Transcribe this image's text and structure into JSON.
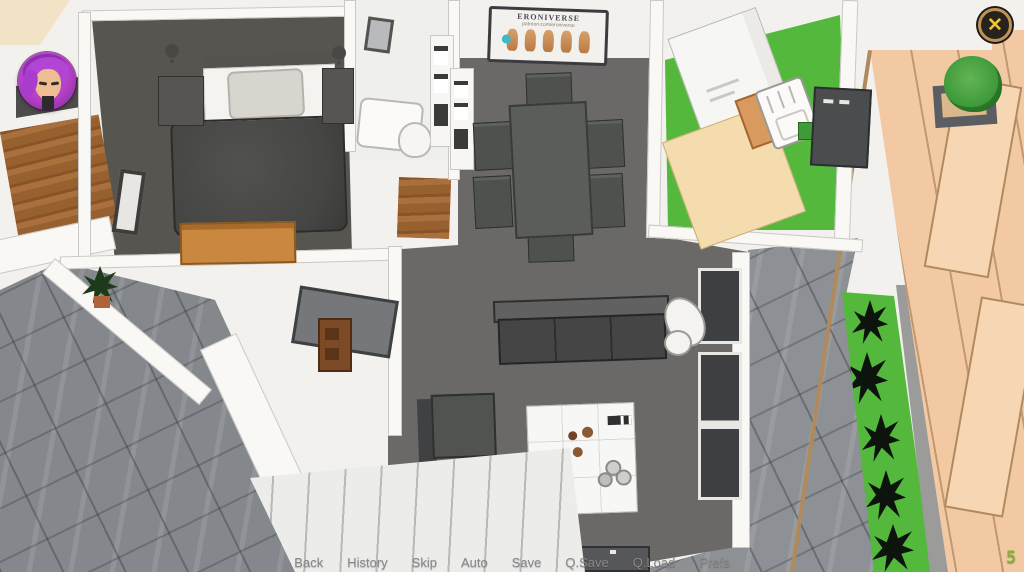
{
  "hud": {
    "avatar_icon": "player-avatar-icon",
    "close_button": {
      "label": "✕"
    },
    "counter": {
      "value": "5"
    }
  },
  "quick_menu": {
    "items": [
      {
        "label": "Back"
      },
      {
        "label": "History"
      },
      {
        "label": "Skip"
      },
      {
        "label": "Auto"
      },
      {
        "label": "Save"
      },
      {
        "label": "Q.Save"
      },
      {
        "label": "Q.Load"
      },
      {
        "label": "Prefs"
      }
    ]
  },
  "scene": {
    "poster": {
      "title": "ERONIVERSE",
      "subtitle": "patreon.com/eroniverse"
    }
  },
  "colors": {
    "hud_ring_gold": "#bf9355",
    "hud_x_yellow": "#eec62f",
    "counter_green": "#8aae3c",
    "kitchen_floor_green": "#54b83d",
    "grass_green": "#54b83d",
    "fence_tan": "#f3c9a3",
    "avatar_magenta": "#b13fc6"
  }
}
